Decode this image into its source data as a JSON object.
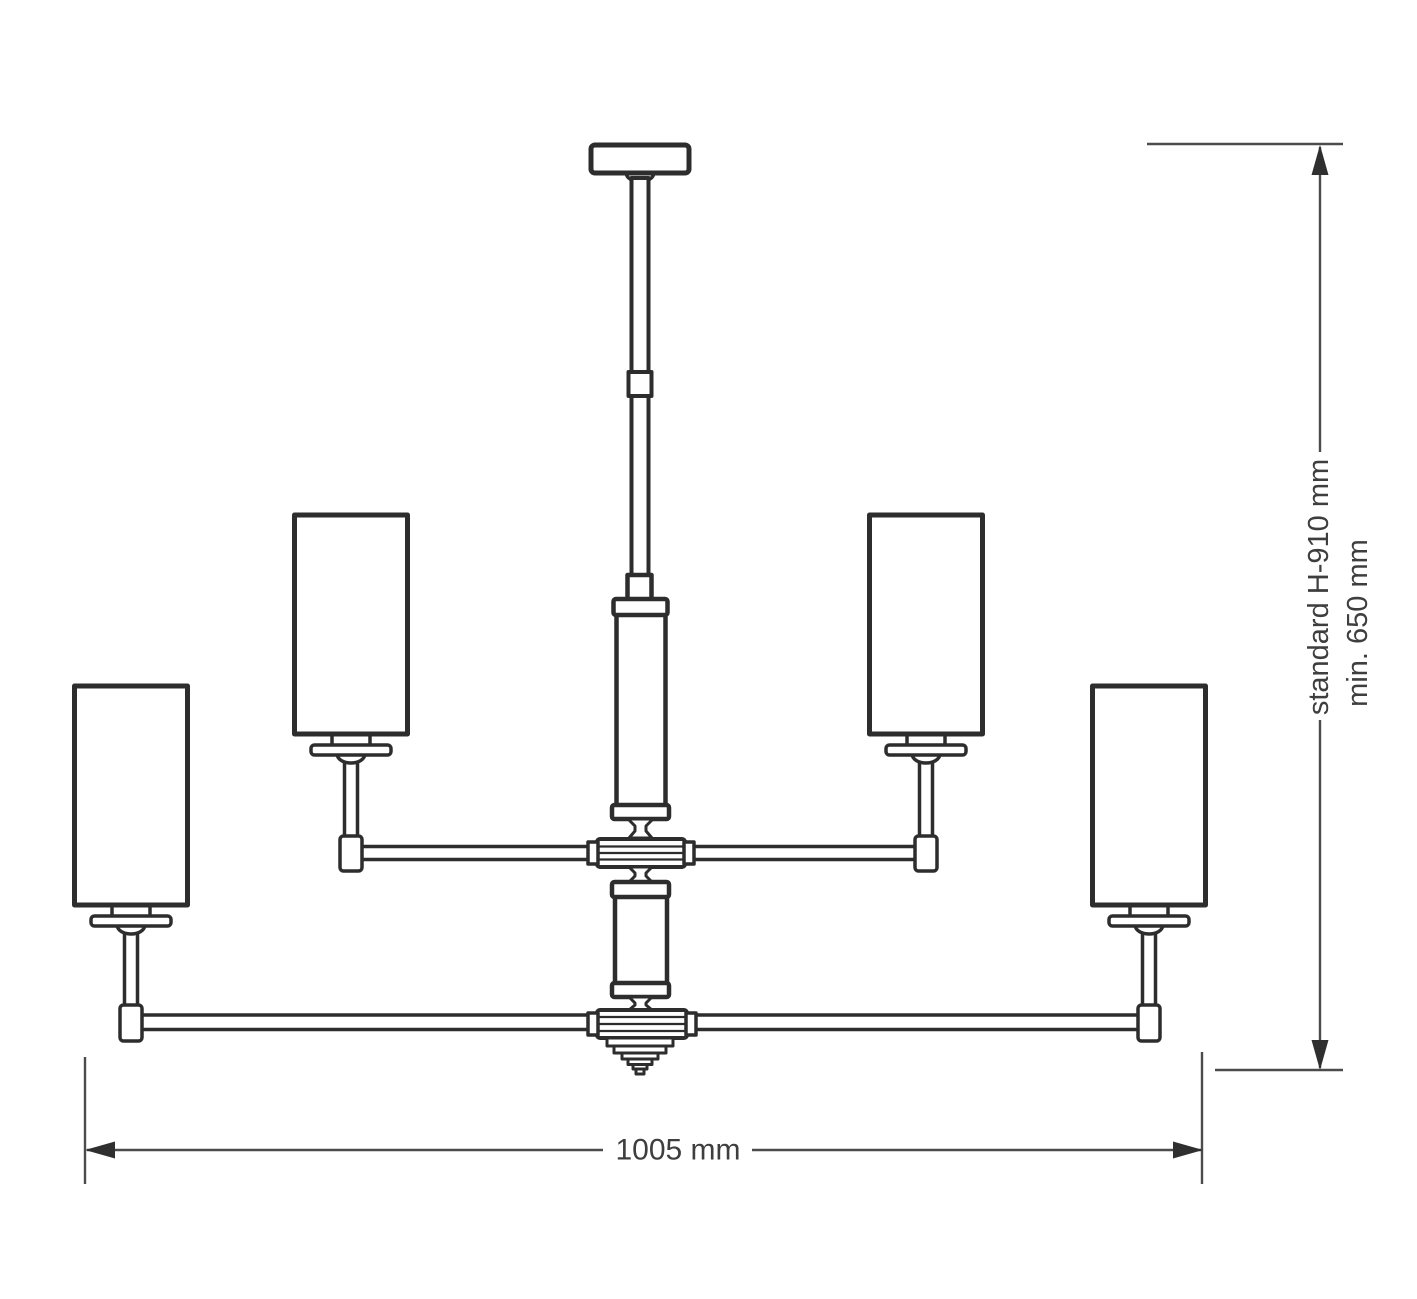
{
  "diagram": {
    "kind": "chandelier-technical-dimension-drawing",
    "dimensions": {
      "height_standard": "standard H-910 mm",
      "height_min": "min. 650 mm",
      "width": "1005 mm"
    },
    "colors": {
      "line": "#2d2d2d",
      "dimension_line": "#4c4c4c",
      "arrow": "#2f2f2f",
      "text": "#3e3e3e",
      "background": "#ffffff"
    }
  }
}
